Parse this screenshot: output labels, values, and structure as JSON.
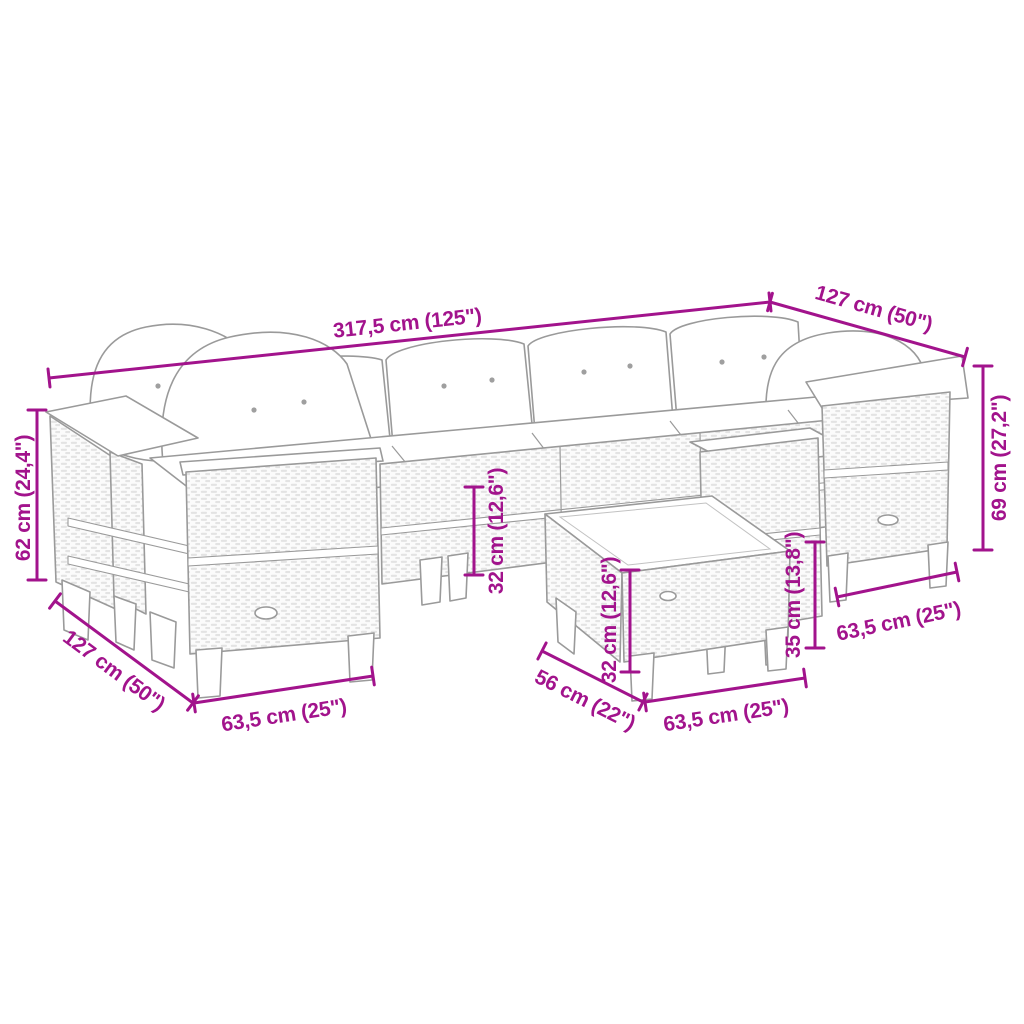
{
  "figure": {
    "description": "Line drawing of a poly rattan garden lounge set (corner sofa with cushions, armrests and square footstool table) annotated with product dimensions"
  },
  "colors": {
    "accent": "#a2138c",
    "line": "#9a9a9a"
  },
  "dimensions": {
    "total_width": {
      "label": "317,5 cm (125\")"
    },
    "right_section_depth": {
      "label": "127 cm (50\")"
    },
    "armrest_height": {
      "label": "69 cm (27,2\")"
    },
    "backrest_height": {
      "label": "62 cm (24,4\")"
    },
    "seat_height": {
      "label": "32 cm (12,6\")"
    },
    "table_height": {
      "label": "32 cm (12,6\")"
    },
    "stool_height": {
      "label": "35 cm (13,8\")"
    },
    "right_seat_width": {
      "label": "63,5 cm (25\")"
    },
    "left_seat_width": {
      "label": "63,5 cm (25\")"
    },
    "table_width": {
      "label": "63,5 cm (25\")"
    },
    "left_section_depth": {
      "label": "127 cm (50\")"
    },
    "table_depth": {
      "label": "56 cm (22\")"
    }
  }
}
